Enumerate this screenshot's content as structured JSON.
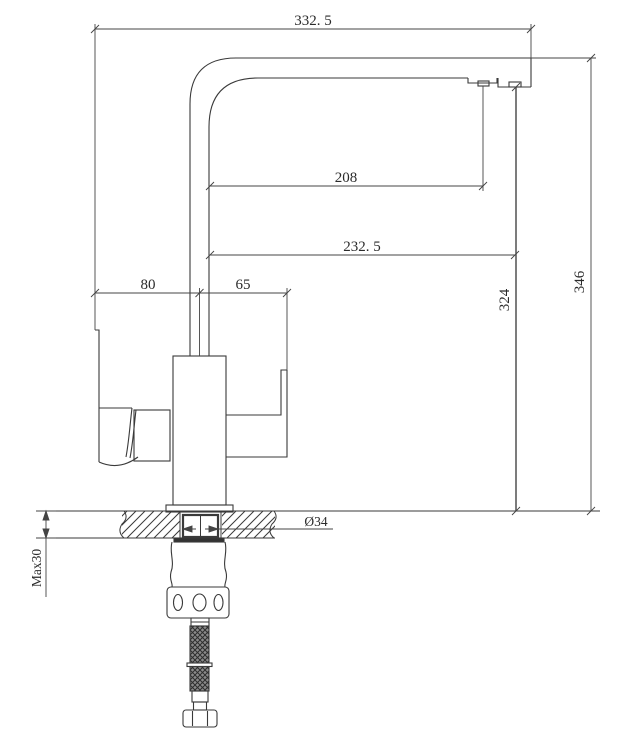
{
  "drawing": {
    "kind": "technical-dimension-drawing",
    "dimensions": {
      "total_reach": "332. 5",
      "aux_outlet_reach": "208",
      "main_outlet_reach": "232. 5",
      "handle_to_axis": "80",
      "axis_to_body_edge": "65",
      "aux_outlet_height": "324",
      "spout_top_height": "346",
      "hole_diameter": "Ø34",
      "max_counter_thickness": "Max30"
    },
    "colors": {
      "line": "#333333",
      "background": "#ffffff"
    }
  }
}
